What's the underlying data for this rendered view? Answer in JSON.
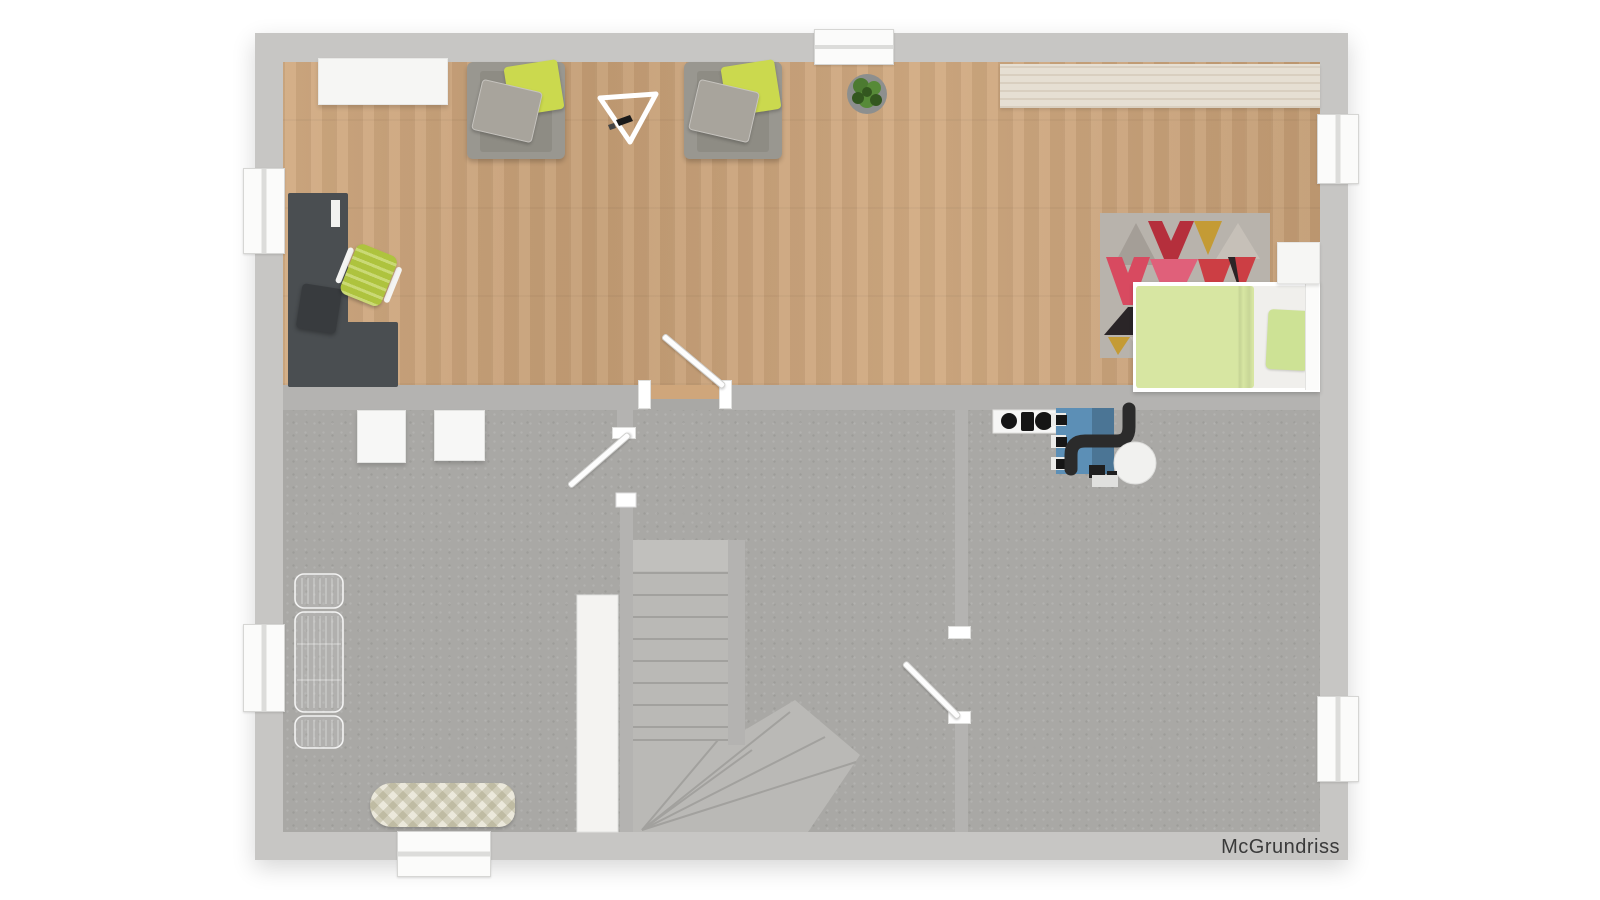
{
  "plan": {
    "watermark": "McGrundriss"
  },
  "items": [
    "sideboard",
    "armchair",
    "green-pillow",
    "gray-pillow",
    "easel",
    "potted-plant",
    "countertop",
    "desk",
    "office-chair",
    "stool",
    "geometric-rug",
    "single-bed",
    "duvet",
    "bed-pillow",
    "nightstand",
    "washing-machine",
    "dryer",
    "drying-rack",
    "ironing-board",
    "staircase",
    "winder-steps",
    "closet",
    "boiler",
    "flue-pipe",
    "expansion-tank",
    "hotplate-panel",
    "window",
    "door-leaf",
    "door-jamb",
    "living-room-wood-floor",
    "basement-gray-floor"
  ],
  "colors": {
    "bg": "#ffffff",
    "wall_outer": "#c7c6c4",
    "wall_inner": "#b4b3b1",
    "floor_gray": "#a9a8a5",
    "stair_tread": "#bab9b6",
    "stair_land": "#c1c0bd",
    "stair_line": "#a2a19e",
    "closet": "#f4f3f1",
    "wood_base": "#cfa67b",
    "counter": "#e6dfd3",
    "sideboard": "#f6f6f4",
    "window_white": "#fbfbfa",
    "door_white": "#fdfdfd",
    "desk": "#4a4e51",
    "stool": "#383b3e",
    "chair_green": "#b5cb40",
    "armchair": "#999790",
    "armchair_seat": "#8e8c84",
    "pillow_green": "#cbd94e",
    "pillow_gray": "#a8a49c",
    "duvet": "#d7e6a2",
    "bed_pillow": "#cde295",
    "mattress": "#f0efec",
    "rug_base": "#b8b3ac",
    "rug_red": "#cc3e44",
    "rug_crimson": "#b52f3c",
    "rug_pink": "#e0607a",
    "rug_rose": "#d84a60",
    "rug_gold": "#c49b35",
    "rug_black": "#2a2527",
    "rug_teal": "#2d8fa6",
    "rug_gray": "#a49e97",
    "rug_gray2": "#c6c0b8",
    "plant_pot": "#8d8f8e",
    "plant_green": "#4c7a31",
    "plant_dark": "#33571f",
    "plant_light": "#578a38",
    "boiler_blue": "#5c8fb6",
    "pipe_black": "#2b2b2b",
    "tank": "#f1f1ef",
    "washer": "#f7f7f6",
    "iron_base": "#ebe8db",
    "watermark": "#3a3a3a"
  }
}
